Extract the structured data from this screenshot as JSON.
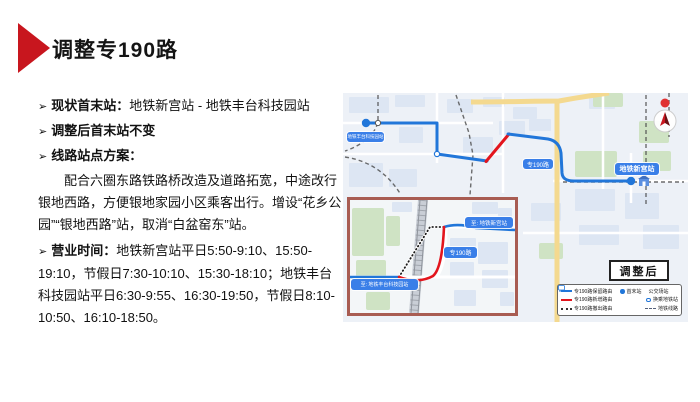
{
  "slide": {
    "title": "调整专190路",
    "accent_color": "#c8161e"
  },
  "content": {
    "bullet_char": "➢",
    "bullets": [
      {
        "label": "现状首末站",
        "colon": "：",
        "text": "地铁新宫站 - 地铁丰台科技园站"
      },
      {
        "label": "调整后首末站不变",
        "colon": "",
        "text": ""
      },
      {
        "label": "线路站点方案",
        "colon": "：",
        "text": ""
      }
    ],
    "plan_paragraph": "配合六圈东路铁路桥改造及道路拓宽，中途改行银地西路，方便银地家园小区乘客出行。增设“花乡公园”“银地西路”站，取消“白盆窑东”站。",
    "hours_label": "营业时间",
    "hours_colon": "：",
    "hours_text": "地铁新宫站平日5:50-9:10、15:50-19:10，节假日7:30-10:10、15:30-18:10；地铁丰台科技园站平日6:30-9:55、16:30-19:50，节假日8:10-10:50、16:10-18:50。"
  },
  "map": {
    "badge": "调整后",
    "main_labels": {
      "left_terminal": "地铁丰台科技园站",
      "route": "专190路",
      "right_terminal": "地铁新宫站"
    },
    "inset_labels": {
      "to_right": "至: 地铁新宫站",
      "route": "专190路",
      "to_left": "至: 地铁丰台科技园站"
    },
    "legend": {
      "routes": [
        {
          "label": "专190路保留路由",
          "color": "#2176d9",
          "style": "solid"
        },
        {
          "label": "专190路新增路由",
          "color": "#e3151d",
          "style": "solid"
        },
        {
          "label": "专190路撤出路由",
          "color": "#333333",
          "style": "dotted"
        }
      ],
      "symbols": [
        {
          "label": "首末站",
          "icon": "terminal-dot"
        },
        {
          "label": "公交场站",
          "icon": "bus-depot"
        },
        {
          "label": "换乘地铁站",
          "icon": "metro-station"
        },
        {
          "label": "地铁线路",
          "icon": "metro-line-dash"
        }
      ]
    },
    "colors": {
      "route_blue": "#2176d9",
      "route_red": "#e3151d",
      "label_pill_blue": "#3a7fe8",
      "inset_border": "#a85c52"
    }
  }
}
